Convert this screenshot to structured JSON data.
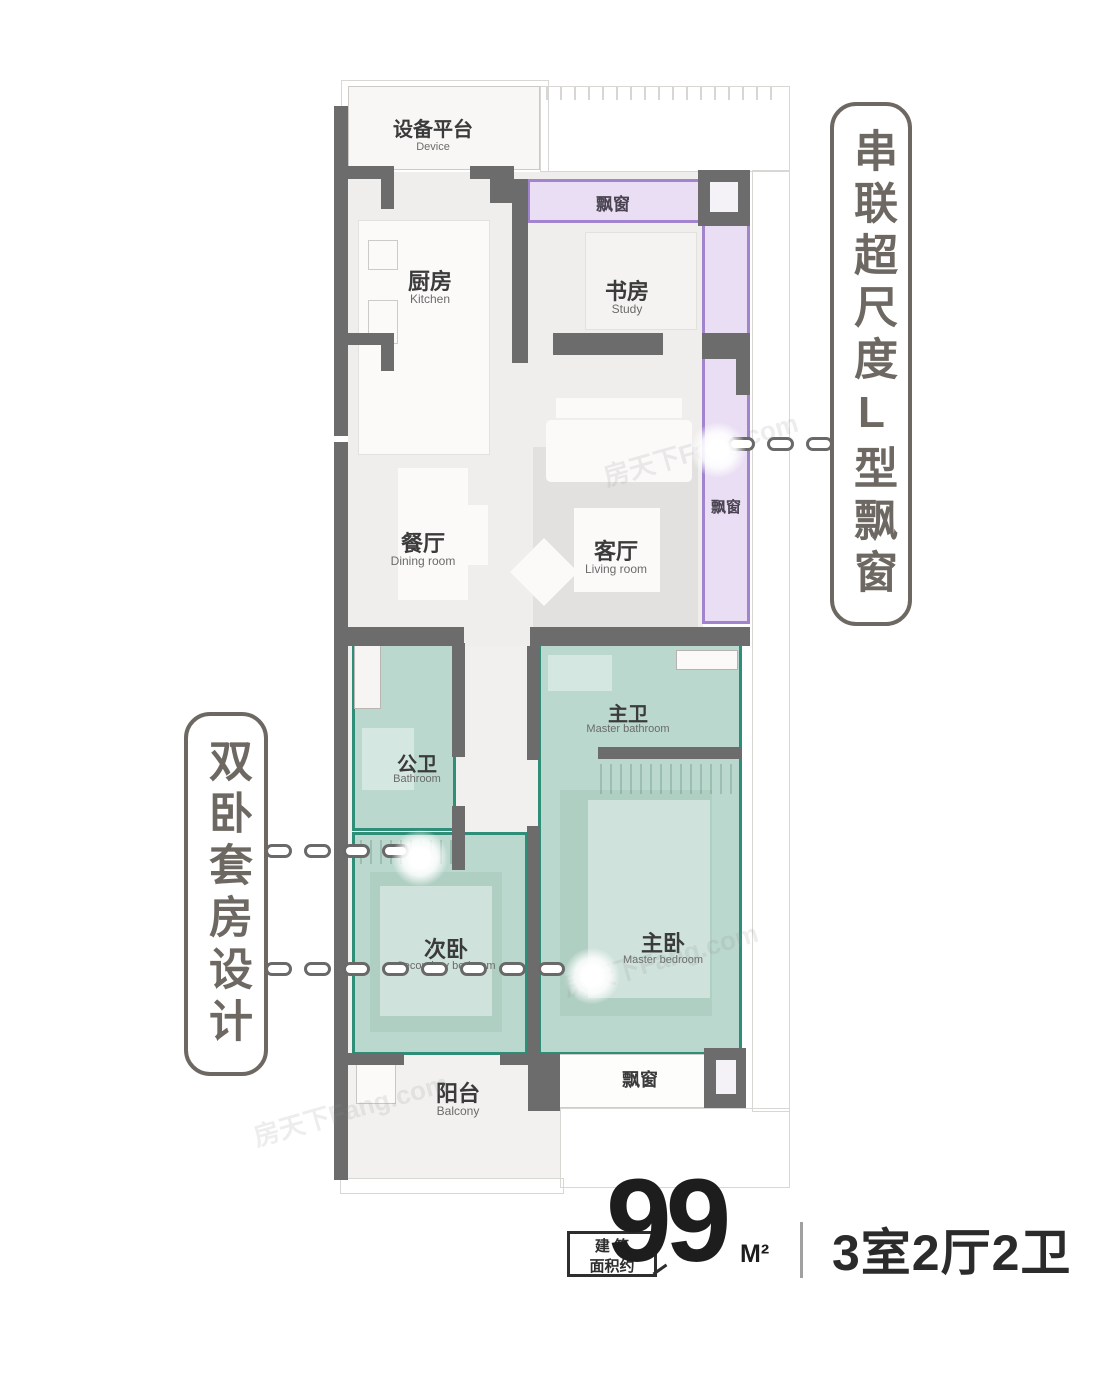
{
  "watermark": "房天下Fang.com",
  "plan": {
    "device": {
      "cn": "设备平台",
      "en": "Device"
    },
    "kitchen": {
      "cn": "厨房",
      "en": "Kitchen"
    },
    "study": {
      "cn": "书房",
      "en": "Study"
    },
    "dining": {
      "cn": "餐厅",
      "en": "Dining room"
    },
    "living": {
      "cn": "客厅",
      "en": "Living room"
    },
    "bath_public": {
      "cn": "公卫",
      "en": "Bathroom"
    },
    "bath_master": {
      "cn": "主卫",
      "en": "Master bathroom"
    },
    "bedroom_secondary": {
      "cn": "次卧",
      "en": "Secondary bedroom"
    },
    "bedroom_master": {
      "cn": "主卧",
      "en": "Master bedroom"
    },
    "balcony": {
      "cn": "阳台",
      "en": "Balcony"
    },
    "bay_window_top": "飘窗",
    "bay_window_right": "飘窗",
    "bay_window_bottom": "飘窗"
  },
  "callouts": {
    "right": "串联超尺度L型飘窗",
    "left": "双卧套房设计"
  },
  "footer": {
    "area_label_line1": "建 筑",
    "area_label_line2": "面积约",
    "area_value": "99",
    "area_unit": "M²",
    "unit_layout": "3室2厅2卫"
  },
  "colors": {
    "wall": "#6c6c6c",
    "teal_fill": "#add2c6",
    "teal_border": "#2f8e77",
    "purple_fill": "#e9def3",
    "purple_border": "#a184cd",
    "callout_text": "#6e6862"
  }
}
